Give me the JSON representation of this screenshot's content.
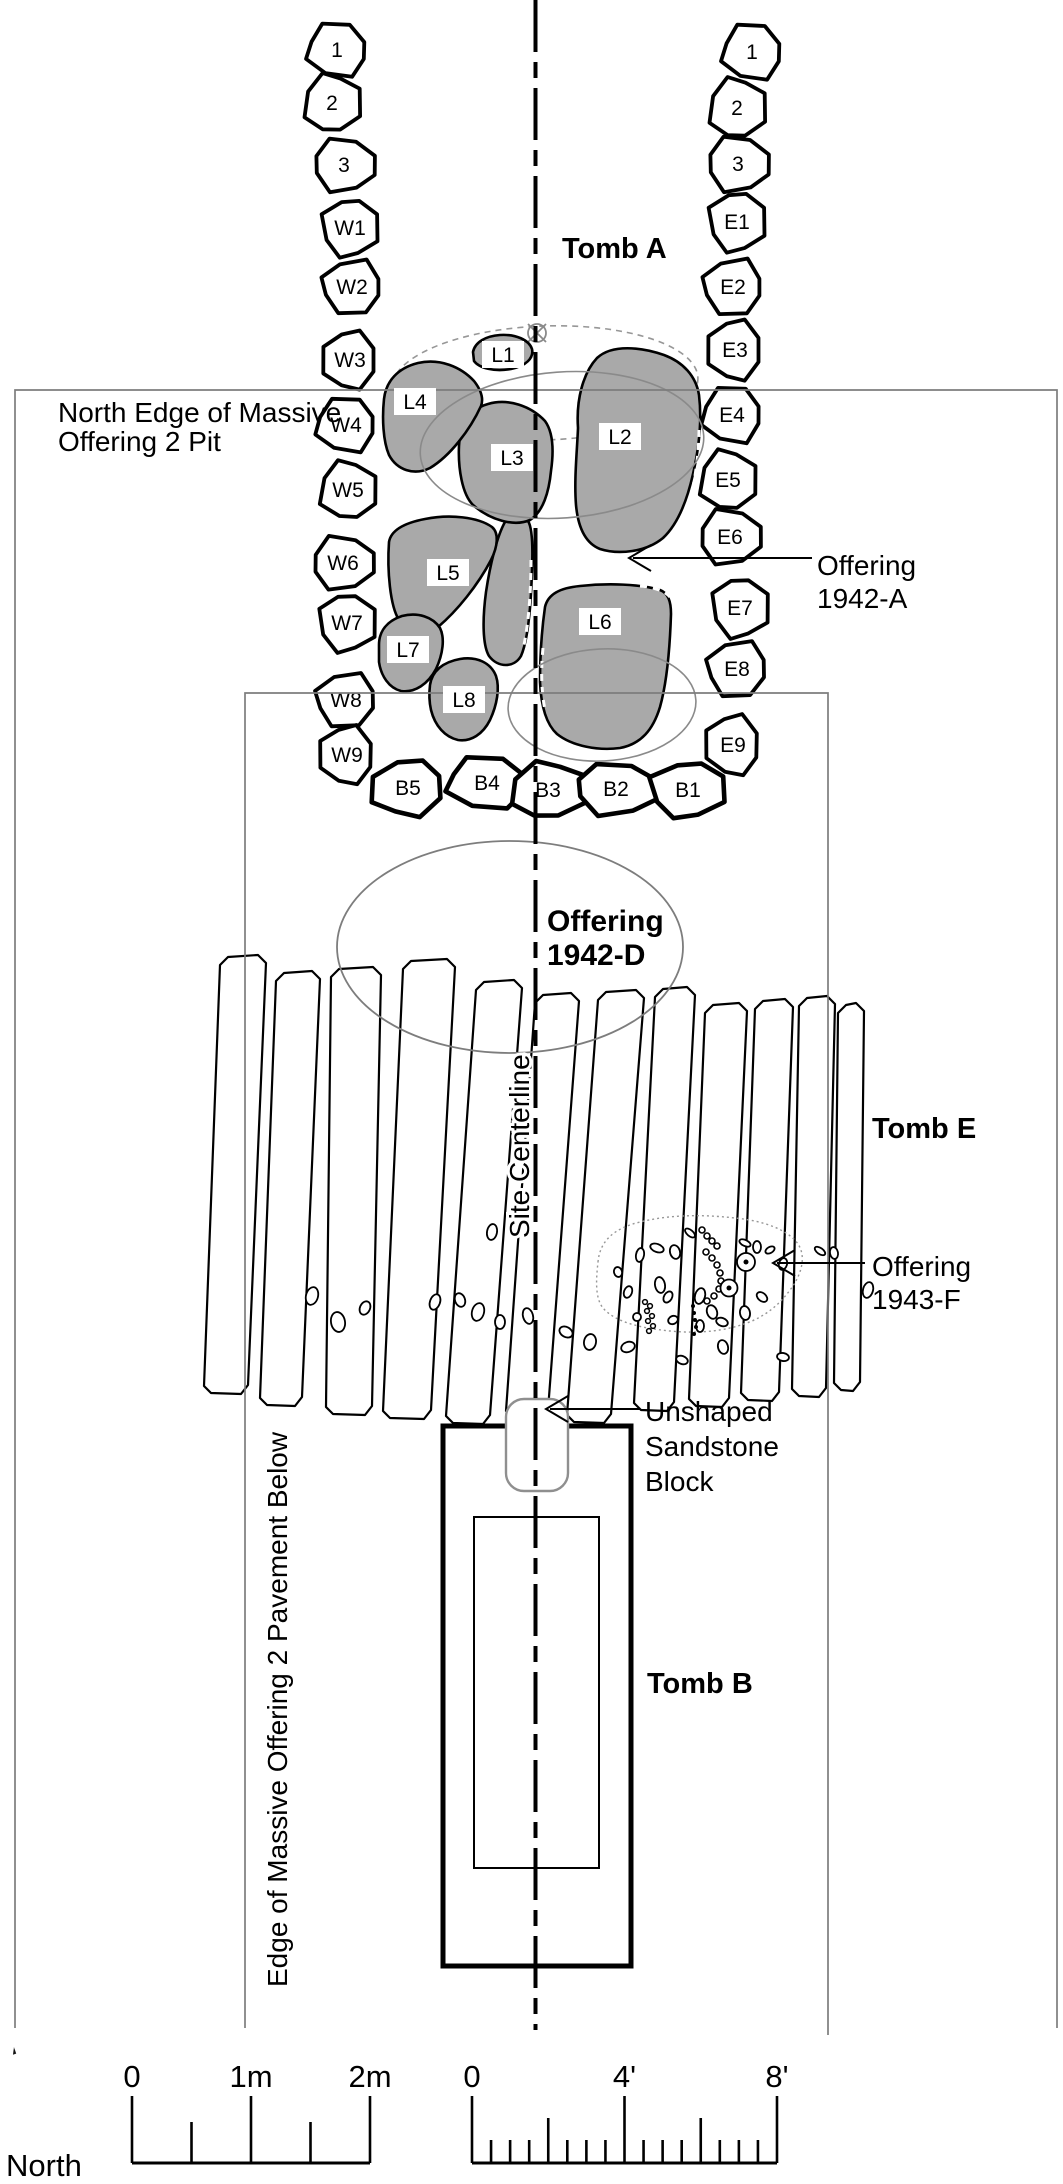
{
  "diagram": {
    "tombs": {
      "a": "Tomb A",
      "e": "Tomb E",
      "b": "Tomb B"
    },
    "offerings": {
      "a1942": {
        "line1": "Offering",
        "line2": "1942-A"
      },
      "d1942": {
        "line1": "Offering",
        "line2": "1942-D"
      },
      "f1943": {
        "line1": "Offering",
        "line2": "1943-F"
      }
    },
    "annotations": {
      "pit_edge": {
        "line1": "North Edge of Massive",
        "line2": "Offering 2 Pit"
      },
      "pavement_edge": "Edge of Massive Offering 2 Pavement Below",
      "centerline": "Site Centerline",
      "sandstone": {
        "line1": "Unshaped",
        "line2": "Sandstone",
        "line3": "Block"
      }
    },
    "stones": {
      "west": [
        "1",
        "2",
        "3",
        "W1",
        "W2",
        "W3",
        "W4",
        "W5",
        "W6",
        "W7",
        "W8",
        "W9"
      ],
      "east": [
        "1",
        "2",
        "3",
        "E1",
        "E2",
        "E3",
        "E4",
        "E5",
        "E6",
        "E7",
        "E8",
        "E9"
      ],
      "bottom": [
        "B5",
        "B4",
        "B3",
        "B2",
        "B1"
      ],
      "slabs": [
        "L1",
        "L2",
        "L3",
        "L4",
        "L5",
        "L6",
        "L7",
        "L8"
      ]
    },
    "compass": {
      "label": "North"
    },
    "scale_m": {
      "t0": "0",
      "t1": "1m",
      "t2": "2m"
    },
    "scale_ft": {
      "t0": "0",
      "t4": "4'",
      "t8": "8'"
    },
    "colors": {
      "ink": "#000000",
      "slab_fill": "#a9a9a9",
      "thin_line": "#7d7d7d",
      "dotted": "#979797"
    }
  }
}
